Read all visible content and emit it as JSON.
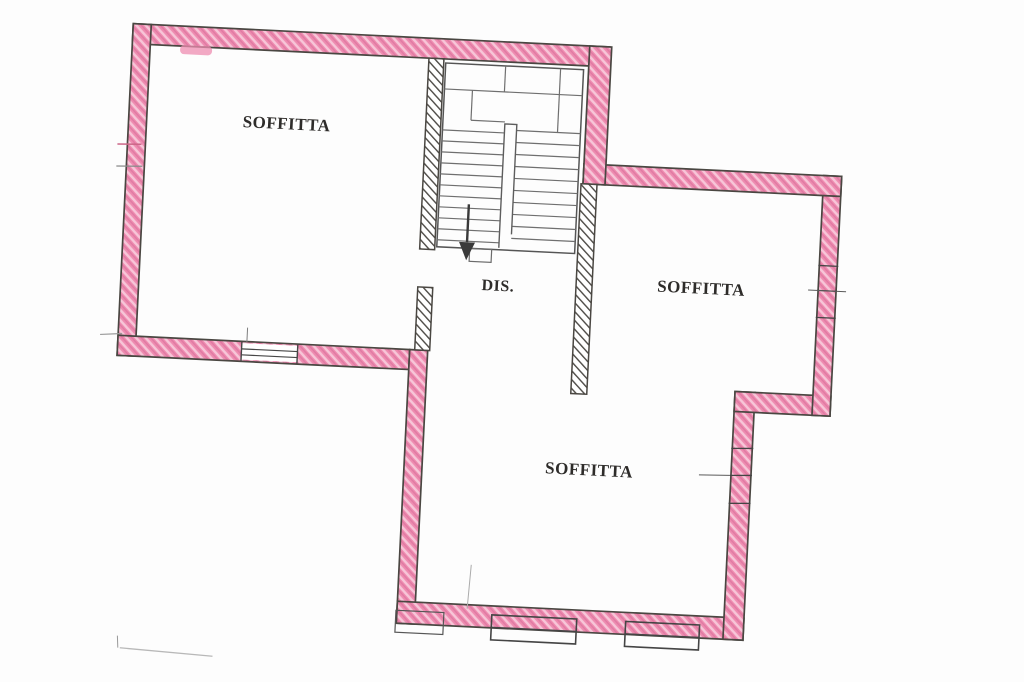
{
  "page": {
    "background": "#fdfdfd",
    "description": "Scanned hand-hatched cadastral floor plan of an attic level"
  },
  "rooms": [
    {
      "id": "soffitta-top-left",
      "label": "SOFFITTA"
    },
    {
      "id": "disimpegno",
      "label": "DIS."
    },
    {
      "id": "soffitta-right",
      "label": "SOFFITTA"
    },
    {
      "id": "soffitta-bottom",
      "label": "SOFFITTA"
    }
  ],
  "stairs": {
    "flights": 2,
    "arrow_direction": "down"
  },
  "colors": {
    "wall_fill": "#ee8cb0",
    "wall_hatch_light": "#ffffff",
    "wall_hatch_dark": "#c75a8c",
    "wall_outline": "#4a4742",
    "interior_wall_hatch": "#4d4a46",
    "stair_lines": "#6b6b6b",
    "label_text": "#2e2c2a"
  }
}
